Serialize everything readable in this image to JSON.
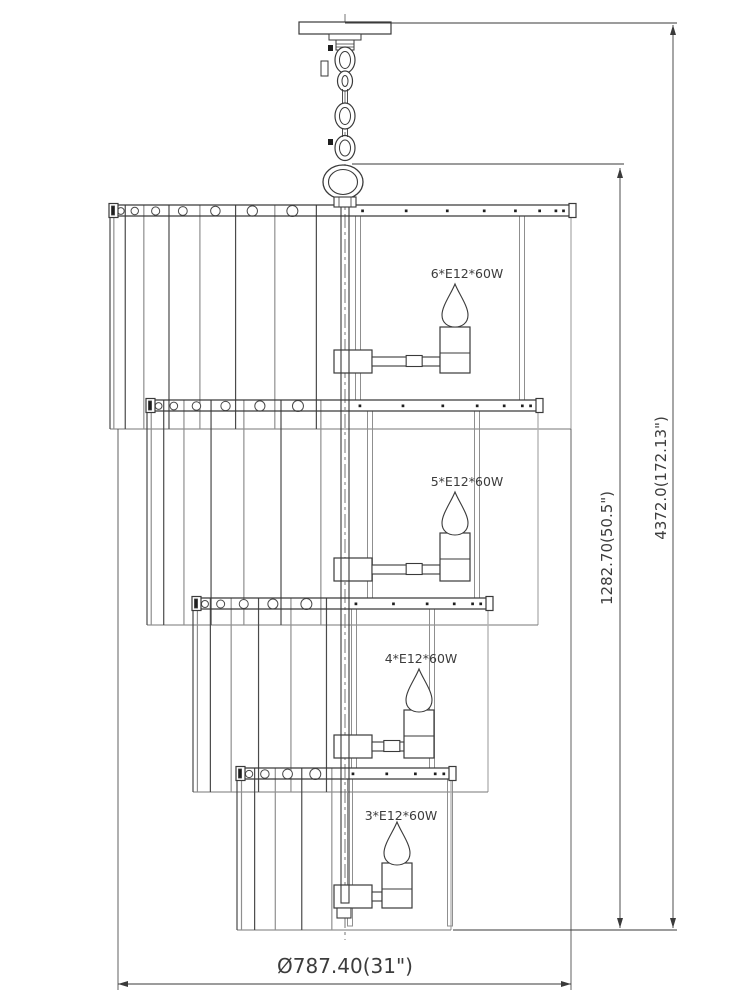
{
  "drawing": {
    "type": "chandelier-technical-line-drawing",
    "tiers": [
      {
        "bulb_label": "6*E12*60W"
      },
      {
        "bulb_label": "5*E12*60W"
      },
      {
        "bulb_label": "4*E12*60W"
      },
      {
        "bulb_label": "3*E12*60W"
      }
    ],
    "dimensions": {
      "overall_height": "4372.0(172.13\")",
      "body_height": "1282.70(50.5\")",
      "diameter": "Ø787.40(31\")"
    },
    "colors": {
      "background": "#ffffff",
      "line": "#3a3a3a",
      "medium_gray": "#8f8f8f",
      "light_gray": "#b5b5b5",
      "text": "#3c3c3c",
      "fill_black": "#1f1f1f"
    }
  }
}
